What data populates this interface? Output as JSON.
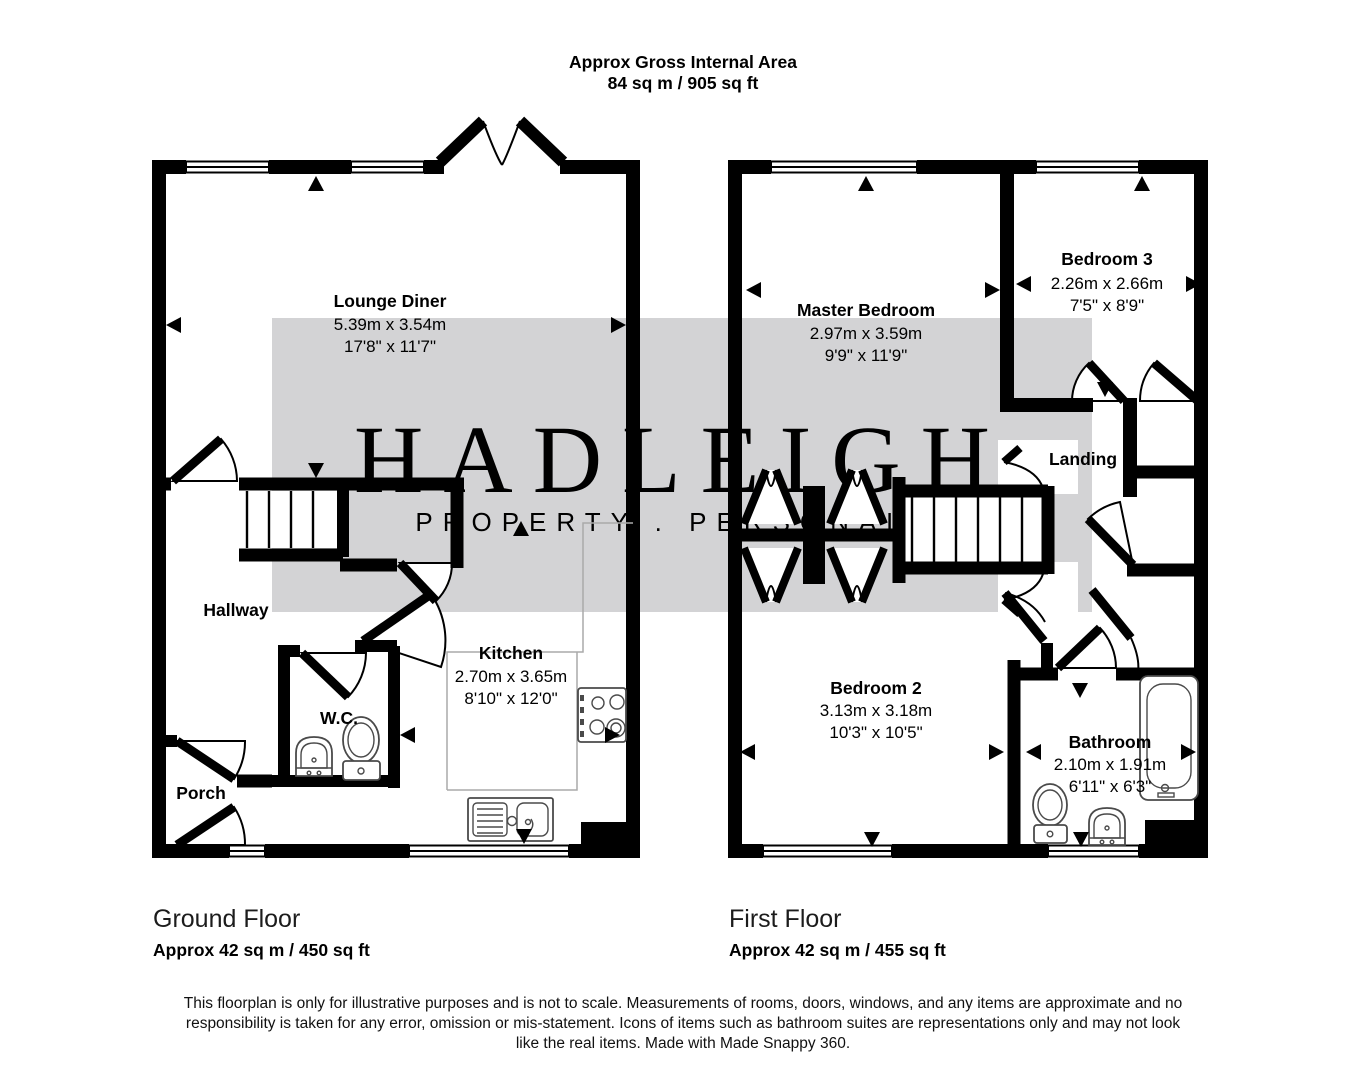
{
  "header": {
    "title": "Approx Gross Internal Area",
    "subtitle": "84 sq m / 905 sq ft"
  },
  "watermark": {
    "brand": "HADLEIGH",
    "tagline": "PROPERTY . PERSONALLY",
    "band_color": "#d3d3d5",
    "brand_color": "#f1e9d7",
    "tagline_color": "#f8f7f3"
  },
  "floors": [
    {
      "name": "Ground Floor",
      "area_label": "Approx 42 sq m / 450 sq ft",
      "rooms": [
        {
          "name": "Lounge Diner",
          "metric": "5.39m x 3.54m",
          "imperial": "17'8\" x 11'7\""
        },
        {
          "name": "Kitchen",
          "metric": "2.70m x 3.65m",
          "imperial": "8'10\" x 12'0\""
        },
        {
          "name": "Hallway"
        },
        {
          "name": "W.C."
        },
        {
          "name": "Porch"
        }
      ]
    },
    {
      "name": "First Floor",
      "area_label": "Approx 42 sq m / 455 sq ft",
      "rooms": [
        {
          "name": "Master Bedroom",
          "metric": "2.97m x 3.59m",
          "imperial": "9'9\" x 11'9\""
        },
        {
          "name": "Bedroom 3",
          "metric": "2.26m x 2.66m",
          "imperial": "7'5\" x 8'9\""
        },
        {
          "name": "Bedroom 2",
          "metric": "3.13m x 3.18m",
          "imperial": "10'3\" x 10'5\""
        },
        {
          "name": "Bathroom",
          "metric": "2.10m x 1.91m",
          "imperial": "6'11\" x 6'3\""
        },
        {
          "name": "Landing"
        }
      ]
    }
  ],
  "disclaimer": "This floorplan is only for illustrative purposes and is not to scale. Measurements of rooms, doors, windows, and any items are approximate and no responsibility is taken for any error, omission or mis-statement. Icons of items such as bathroom suites are representations only and may not look like the real items. Made with Made Snappy 360."
}
